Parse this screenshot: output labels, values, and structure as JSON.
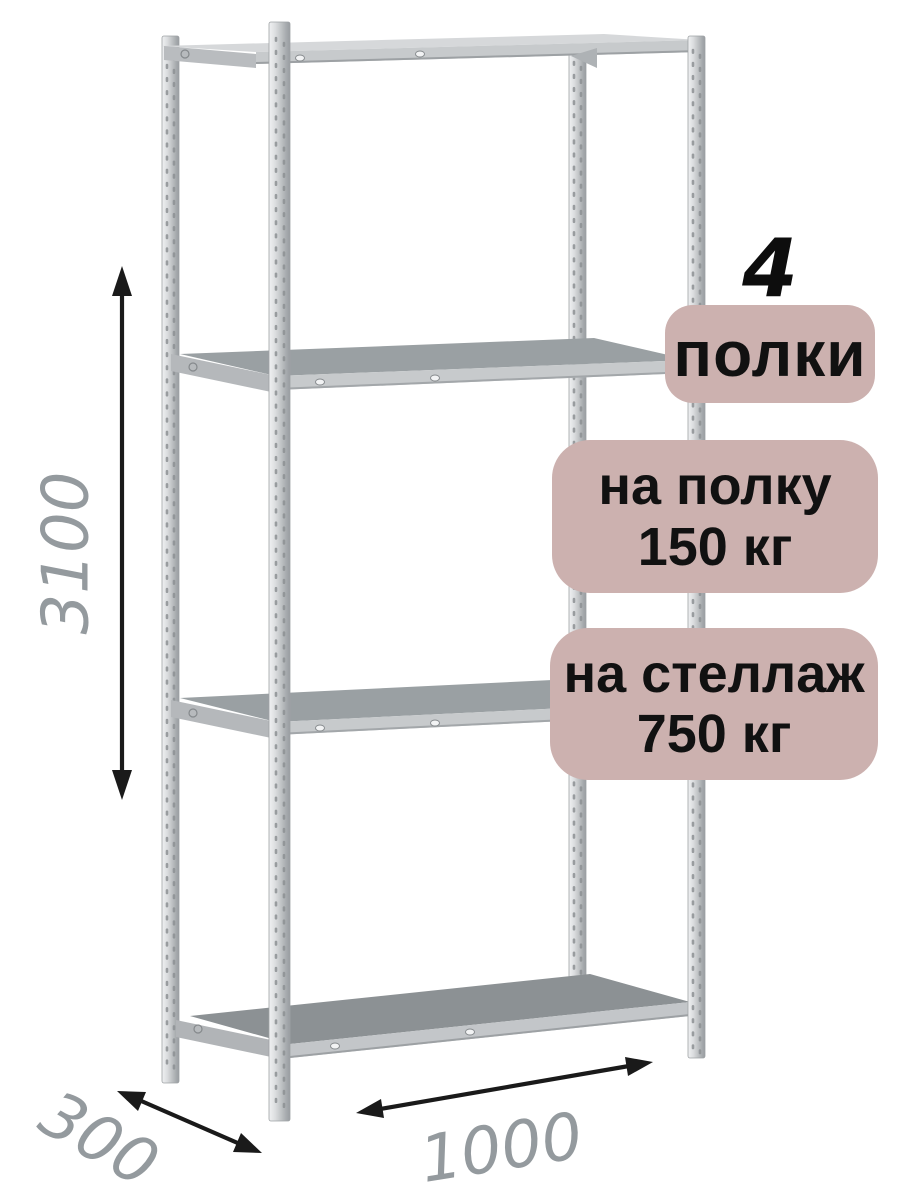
{
  "badges": {
    "shelf_count": "4",
    "shelf_count_label": "полки",
    "per_shelf_line1": "на полку",
    "per_shelf_line2": "150 кг",
    "per_rack_line1": "на стеллаж",
    "per_rack_line2": "750 кг"
  },
  "dimensions": {
    "height": "3100",
    "depth": "300",
    "width": "1000"
  },
  "colors": {
    "badge_bg": "#ccb1af",
    "badge_text": "#111111",
    "count_text": "#0d0d0d",
    "dimension_text": "#949a9e",
    "arrow": "#1a1a1a",
    "metal_light": "#d6d8da",
    "metal_front": "#c7cacc",
    "shelf_top": "#9aa0a3",
    "shelf_top_dark": "#8c9194",
    "post_dark": "#989ca0"
  },
  "icons": {
    "height_arrow": "double-headed-vertical-arrow",
    "depth_arrow": "double-headed-diagonal-arrow",
    "width_arrow": "double-headed-diagonal-arrow"
  }
}
